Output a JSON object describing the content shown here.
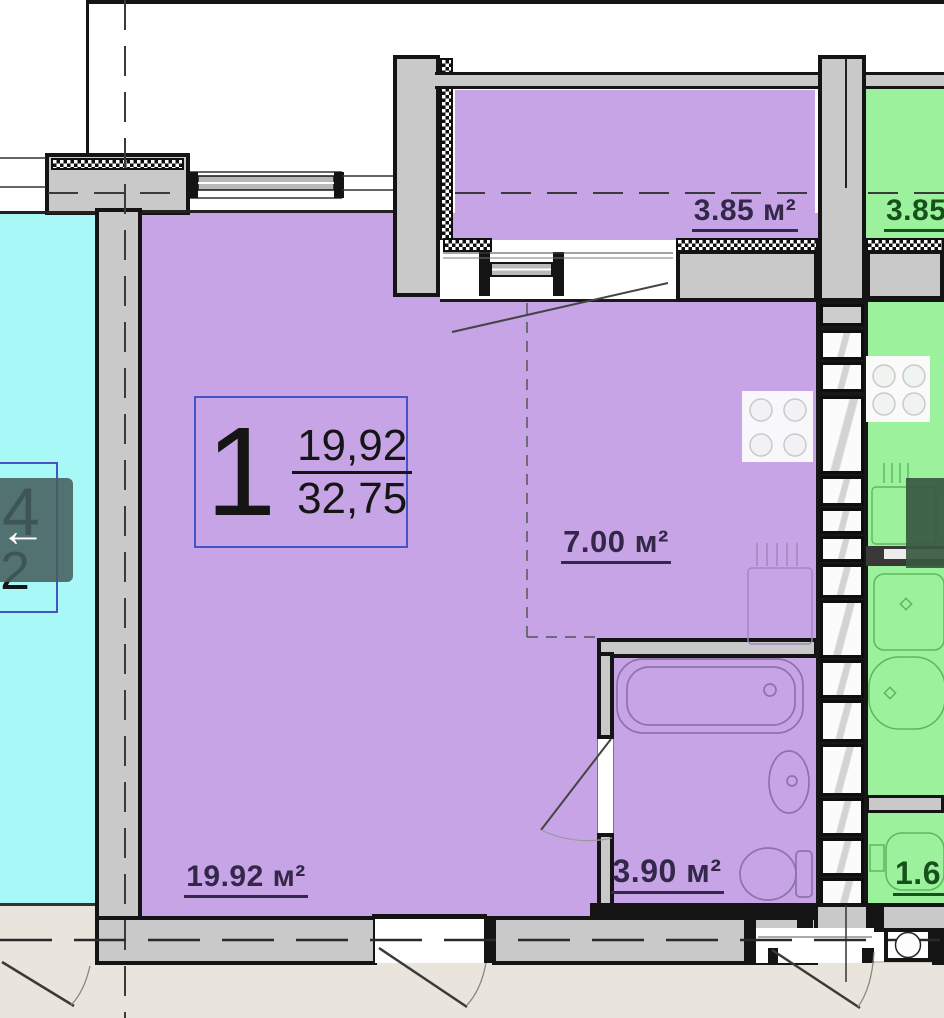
{
  "viewer": {
    "prev_arrow_glyph": "←"
  },
  "cards": {
    "apartment": {
      "number": "1",
      "area_top": "19,92",
      "area_bottom": "32,75"
    },
    "neighbor_left": {
      "line1": "04",
      "line2": "22"
    }
  },
  "labels": {
    "balcony_left": "3.85 м²",
    "balcony_right": "3.85",
    "kitchen_zone": "7.00 м²",
    "living_room": "19.92 м²",
    "bathroom": "3.90 м²",
    "neighbor_right_room": "1.6"
  },
  "colors": {
    "room_purple": "#c7a4e6",
    "room_cyan": "#a8f8f8",
    "room_green": "#9cf29c",
    "wall_gray": "#c9c9c9",
    "wall_outline": "#141414",
    "exterior_beige": "#e9e5dc",
    "card_border": "#4653c4",
    "nav_overlay": "#465e5e"
  }
}
